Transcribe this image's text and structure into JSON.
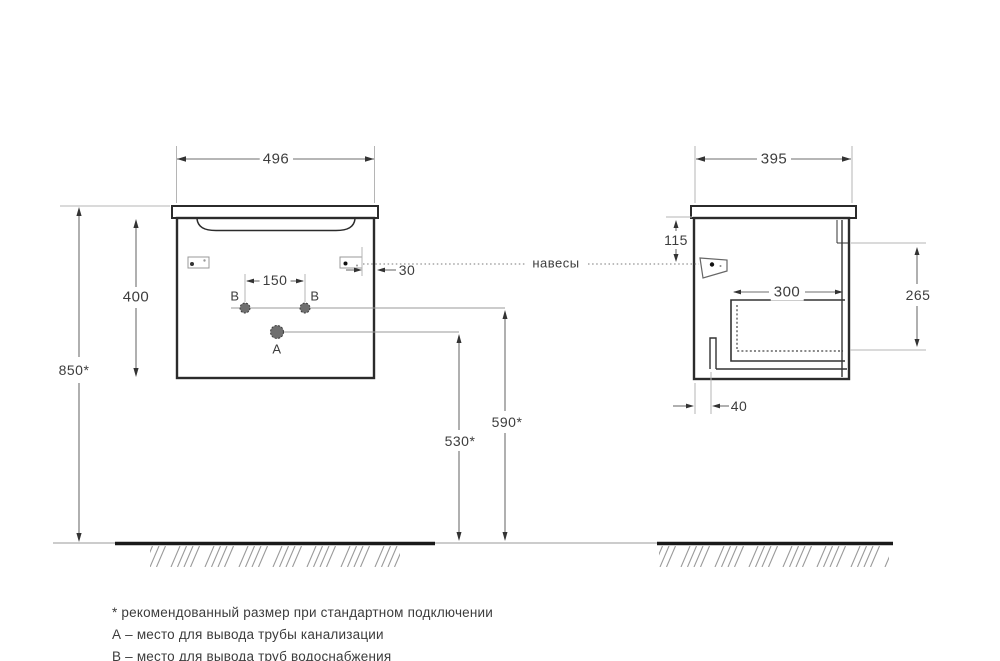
{
  "drawing": {
    "title_context": "cabinet installation diagram",
    "hangers_label": "навесы",
    "front_view": {
      "width": "496",
      "cabinet_height": "400",
      "mount_height": "850*",
      "holes_spacing": "150",
      "hanger_inset": "30",
      "drain_outlet_height": "530*",
      "water_outlet_height": "590*",
      "hole_a": "A",
      "hole_b": "B"
    },
    "side_view": {
      "depth": "395",
      "hanger_drop": "115",
      "drawer_depth": "300",
      "inner_height": "265",
      "toe_offset": "40"
    },
    "notes": [
      "* рекомендованный размер при стандартном подключении",
      "А – место для вывода трубы канализации",
      "В – место для вывода труб водоснабжения"
    ],
    "colors": {
      "outline": "#2b2b2b",
      "dimension_line": "#6e6e6e",
      "extension_line": "#b5b5b5",
      "text": "#3d3d3d",
      "ground": "#1a1a1a",
      "hatch": "#9a9a9a"
    }
  }
}
